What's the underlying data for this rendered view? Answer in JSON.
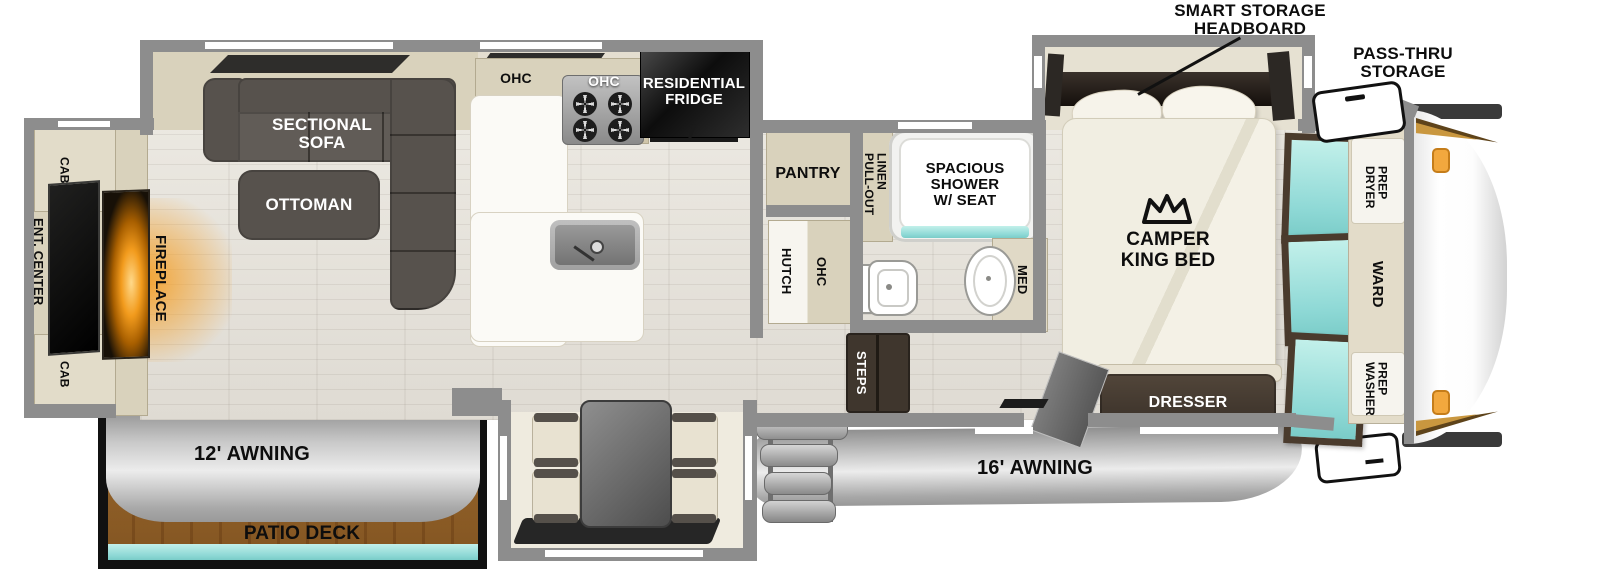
{
  "labels": {
    "cab_top": "CAB",
    "ent_center": "ENT. CENTER",
    "cab_bottom": "CAB",
    "fireplace": "FIREPLACE",
    "sectional_sofa": "SECTIONAL\nSOFA",
    "ottoman": "OTTOMAN",
    "ohc_left": "OHC",
    "ohc_stove": "OHC",
    "residential_fridge": "RESIDENTIAL\nFRIDGE",
    "pantry": "PANTRY",
    "hutch": "HUTCH",
    "hutch_ohc": "OHC",
    "pull_out_linen": "PULL-OUT\nLINEN",
    "spacious_shower": "SPACIOUS\nSHOWER\nW/ SEAT",
    "med": "MED",
    "steps": "STEPS",
    "smart_storage_headboard": "SMART STORAGE\nHEADBOARD",
    "pass_thru_storage": "PASS-THRU\nSTORAGE",
    "camper_king_bed": "CAMPER\nKING BED",
    "dresser": "DRESSER",
    "dryer_prep": "DRYER\nPREP",
    "ward": "WARD",
    "washer_prep": "WASHER\nPREP",
    "awning_16": "16' AWNING",
    "awning_12": "12' AWNING",
    "patio_deck": "PATIO DECK"
  },
  "icons": {
    "crown": "crown-icon"
  },
  "colors": {
    "wall": "#8d8d8d",
    "window_mark": "#ffffff",
    "cabinet_beige": "#d9d2bc",
    "dark_furniture": "#57524d",
    "dark_wood": "#3f362d",
    "teal_glass": "#8fd9d6",
    "fireplace_glow": "#f29b1d",
    "awning_gray": "#c6c6c6",
    "deck_wood": "#bf9d68",
    "gold_accent": "#a87a32",
    "marker_light": "#f2a83e",
    "fridge_black": "#0d0d0d"
  }
}
